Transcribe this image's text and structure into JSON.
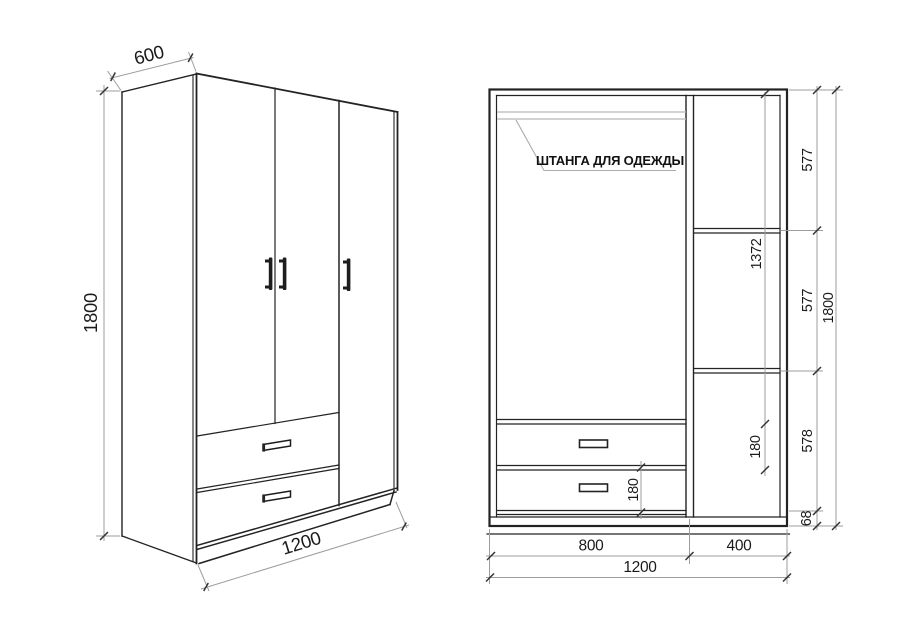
{
  "colors": {
    "background": "#ffffff",
    "cabinet_line": "#232323",
    "dimension_line": "#9d9d9d",
    "tick": "#333333",
    "rod_line": "#b8b8b8",
    "text": "#1a1a1a"
  },
  "perspective_view": {
    "dim_depth": "600",
    "dim_height": "1800",
    "dim_width": "1200"
  },
  "front_view": {
    "rod_label": "ШТАНГА ДЛЯ ОДЕЖДЫ",
    "dim_section_top": "577",
    "dim_section_middle": "577",
    "dim_section_bottom": "578",
    "dim_plinth_height": "68",
    "dim_total_height": "1800",
    "dim_hanging_space": "1372",
    "dim_upper_drawer": "180",
    "dim_lower_drawer": "180",
    "dim_left_section_width": "800",
    "dim_right_section_width": "400",
    "dim_total_width": "1200"
  }
}
